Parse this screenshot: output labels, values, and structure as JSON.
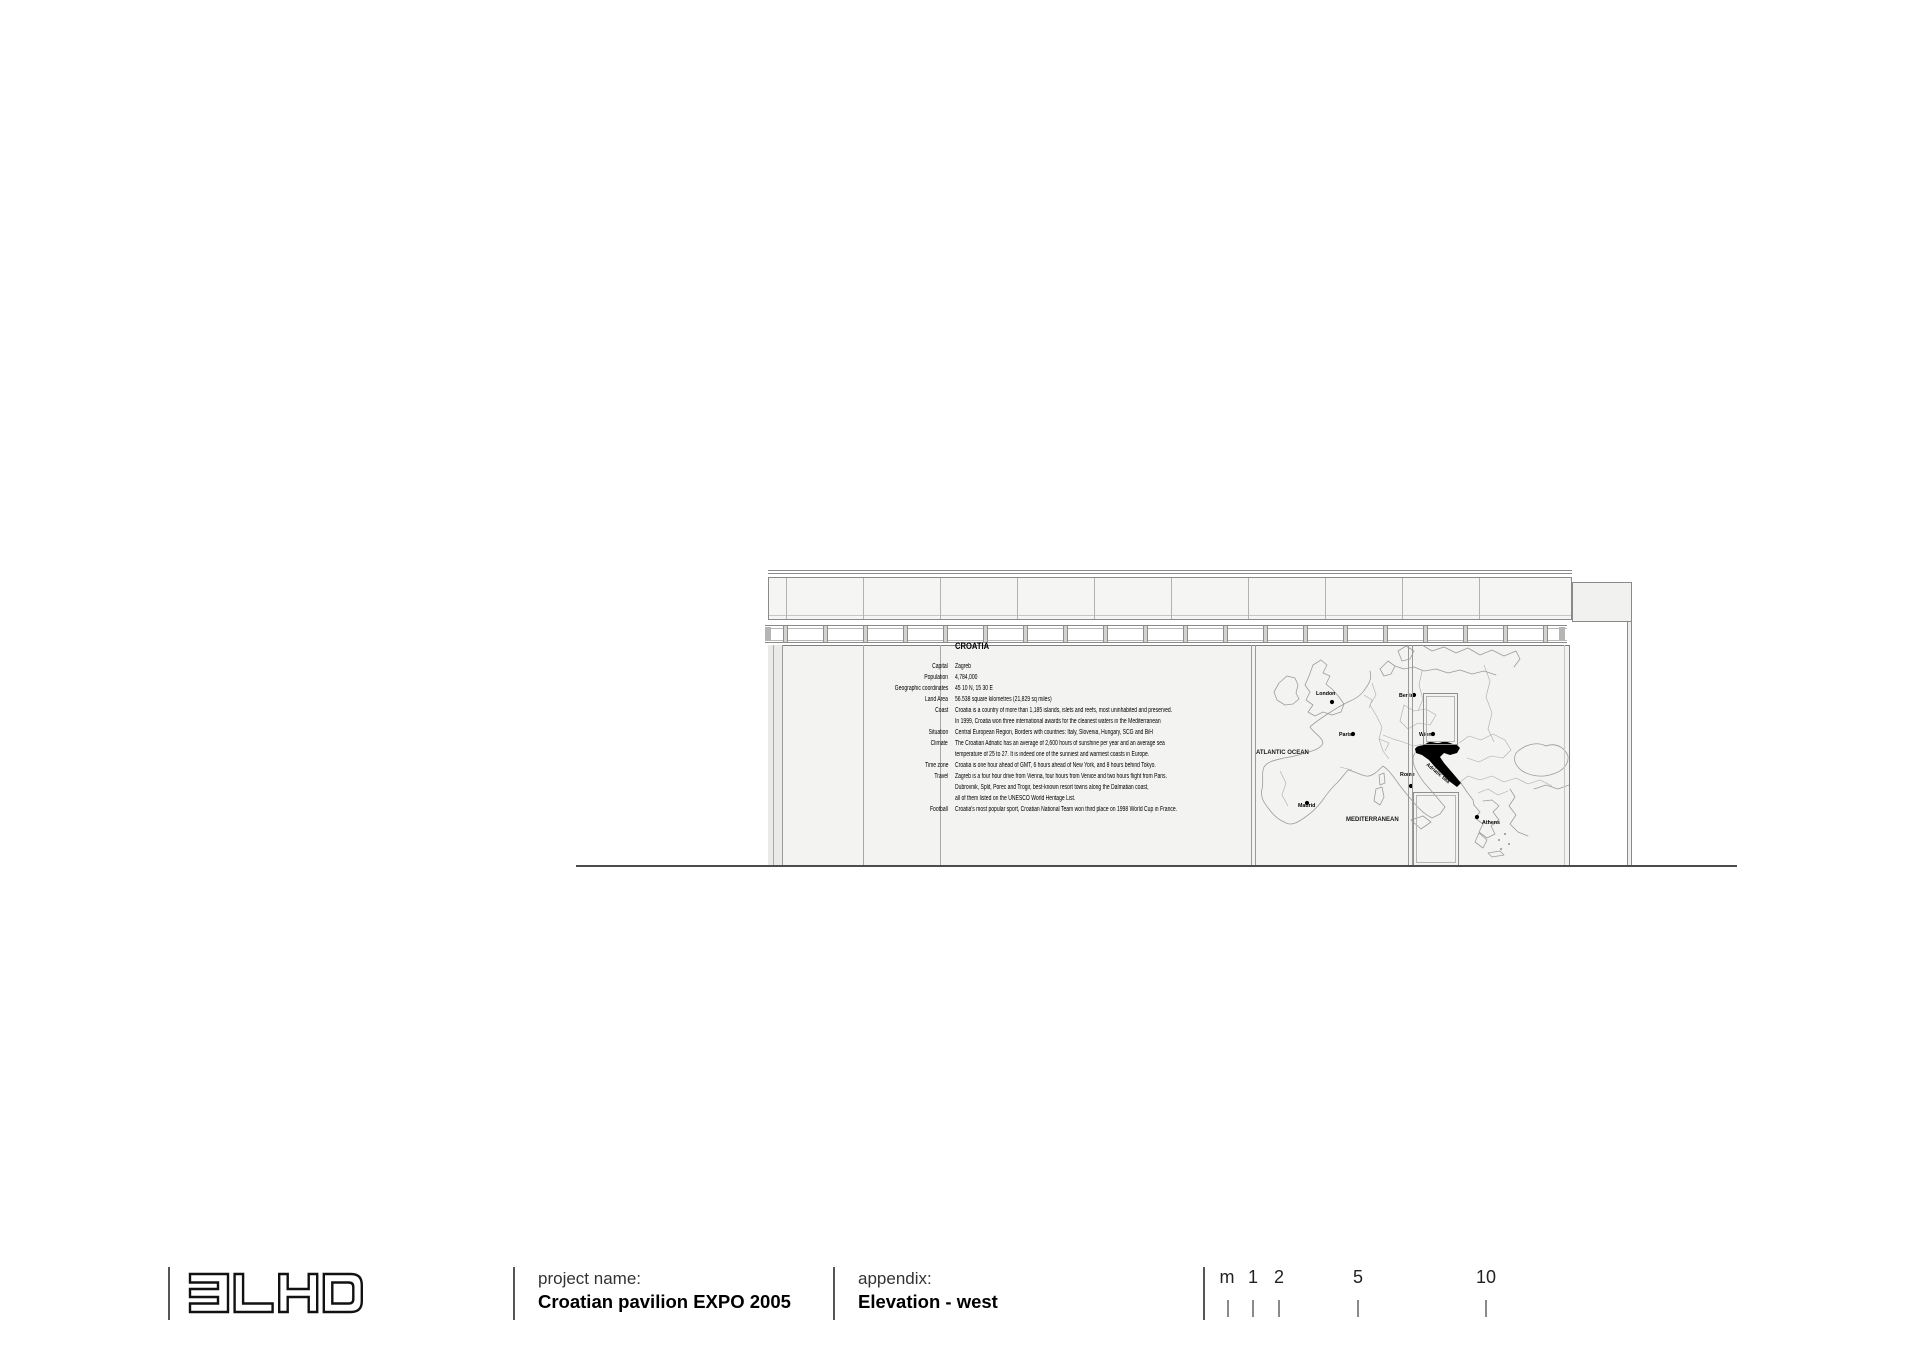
{
  "sheet": {
    "background": "#ffffff"
  },
  "colors": {
    "line_grey": "#8a8a8a",
    "wall_fill": "#f3f3f1",
    "ground_line": "#4c4c4c",
    "map_line": "#9c9c9c",
    "croatia_highlight": "#000000"
  },
  "title_block": {
    "logo": "3LHD",
    "project": {
      "label": "project name:",
      "value": "Croatian pavilion EXPO 2005"
    },
    "appendix": {
      "label": "appendix:",
      "value": "Elevation - west"
    },
    "scale_bar": {
      "unit": "m",
      "marks": [
        "1",
        "2",
        "5",
        "10"
      ]
    }
  },
  "elevation": {
    "info_panel": {
      "title": "CROATIA",
      "rows": [
        {
          "label": "Capital",
          "text": "Zagreb"
        },
        {
          "label": "Population",
          "text": "4,784,000"
        },
        {
          "label": "Geographic coordinates",
          "text": "45 10 N, 15 30 E"
        },
        {
          "label": "Land Area",
          "text": "56.538 square kilometres (21,829 sq miles)"
        },
        {
          "label": "Coast",
          "text": "Croatia is a country of more than 1,185 islands, islets and reefs, most uninhabited and preserved."
        },
        {
          "label": "",
          "text": "In 1999, Croatia won three international awards for the cleanest waters in the Mediterranean"
        },
        {
          "label": "Situation",
          "text": "Central European Region, Borders with countries: Italy, Slovenia, Hungary, SCG and BiH"
        },
        {
          "label": "Climate",
          "text": "The Croatian Adriatic has an average of 2,600 hours of sunshine per year and an average sea"
        },
        {
          "label": "",
          "text": "temperature of 25 to 27. It is indeed one of the sunniest and warmest coasts in Europe."
        },
        {
          "label": "Time zone",
          "text": "Croatia is one hour ahead of GMT, 6 hours ahead of New York, and 8 hours behind Tokyo."
        },
        {
          "label": "Travel",
          "text": "Zagreb is a four hour drive from Vienna, four hours from Venice and two hours flight from Paris."
        },
        {
          "label": "",
          "text": "Dubrovnik, Split, Porec and Trogir, best-known resort towns along the Dalmatian coast,"
        },
        {
          "label": "",
          "text": "all of them listed on the UNESCO World Heritage List."
        },
        {
          "label": "Football",
          "text": "Croatia's most popular sport, Croatian National Team won third place on 1998 World Cup in France."
        }
      ]
    },
    "map": {
      "ocean_label": "ATLANTIC OCEAN",
      "sea_label_south": "MEDITERRANEAN",
      "sea_label_adriatic": "Adriatic Sea",
      "cities": [
        {
          "name": "London"
        },
        {
          "name": "Paris"
        },
        {
          "name": "Berlin"
        },
        {
          "name": "Wien"
        },
        {
          "name": "Rome"
        },
        {
          "name": "Madrid"
        },
        {
          "name": "Athens"
        }
      ]
    }
  }
}
